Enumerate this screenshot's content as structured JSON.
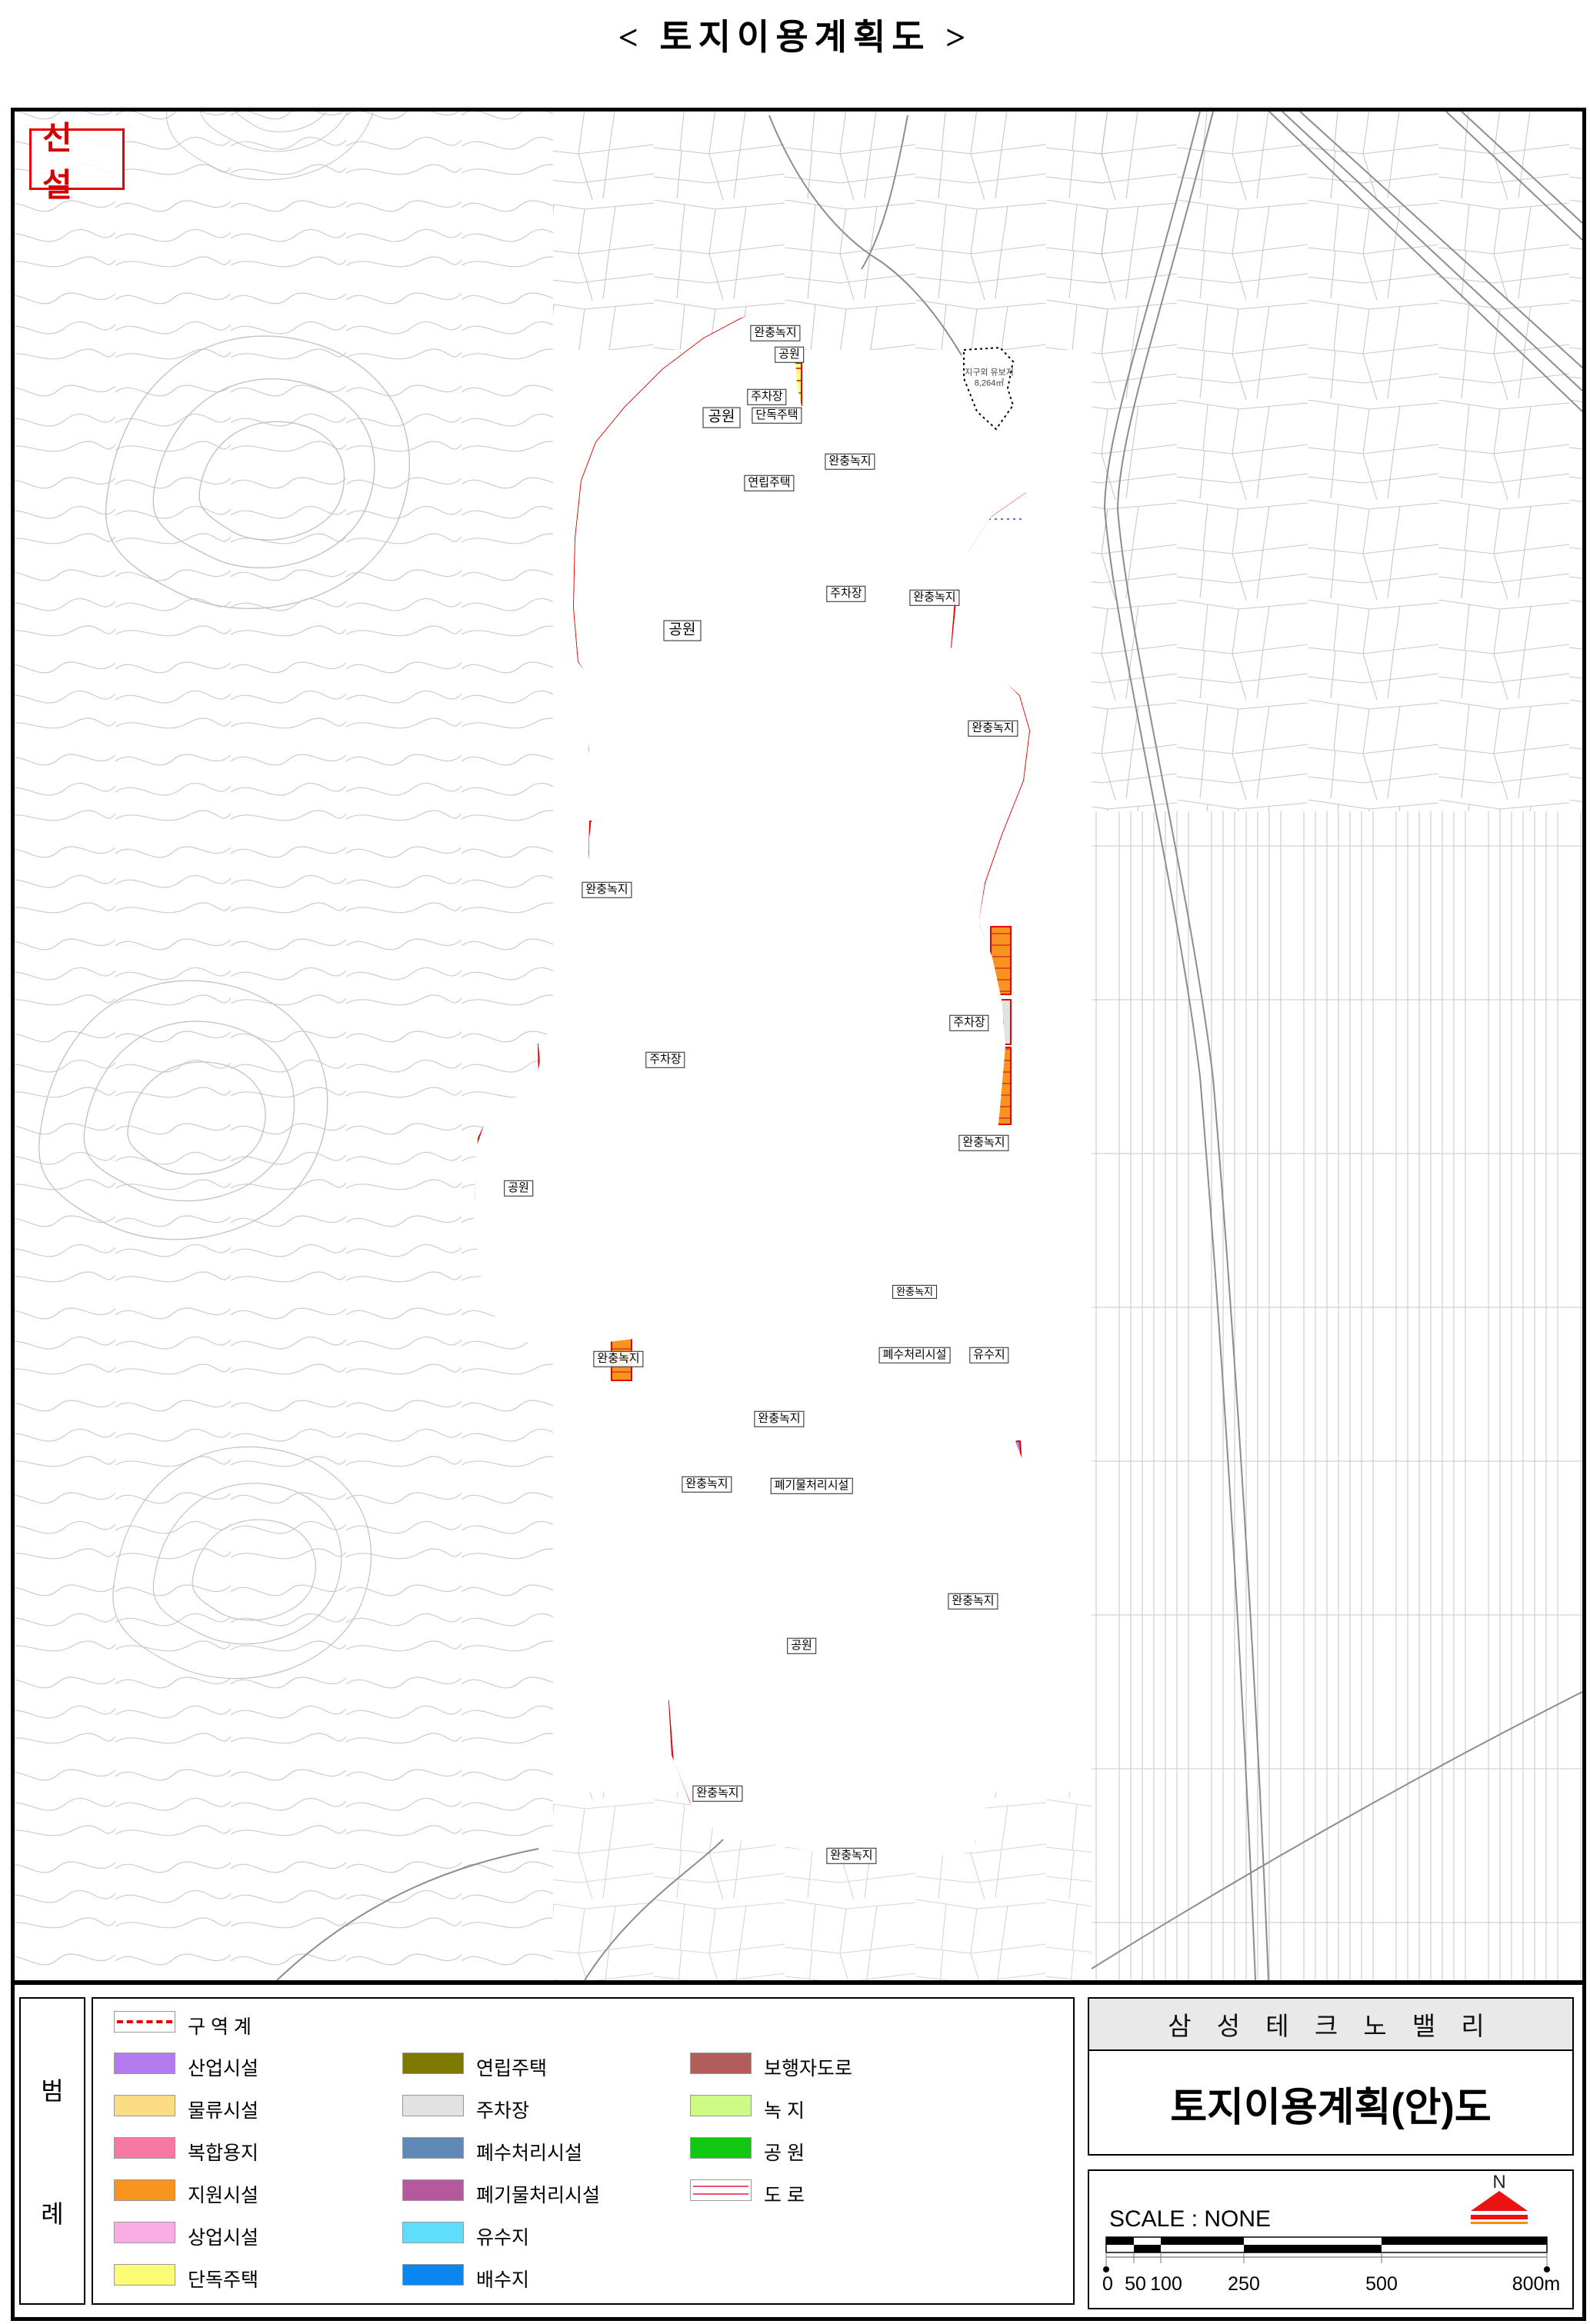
{
  "page": {
    "title": "< 토지이용계획도 >"
  },
  "map": {
    "corner_tag": "신 설",
    "annex": {
      "line1": "지구외 유보지",
      "line2": "8,264㎡"
    },
    "labels": [
      {
        "text": "완충녹지"
      },
      {
        "text": "공원"
      },
      {
        "text": "주차장"
      },
      {
        "text": "단독주택"
      },
      {
        "text": "연립주택"
      },
      {
        "text": "완충녹지"
      },
      {
        "text": "공원"
      },
      {
        "text": "주차장"
      },
      {
        "text": "완충녹지"
      },
      {
        "text": "공원"
      },
      {
        "text": "완충녹지"
      },
      {
        "text": "완충녹지"
      },
      {
        "text": "주차장"
      },
      {
        "text": "주차장"
      },
      {
        "text": "공원"
      },
      {
        "text": "완충녹지"
      },
      {
        "text": "완충녹지"
      },
      {
        "text": "완충녹지"
      },
      {
        "text": "폐수처리시설"
      },
      {
        "text": "유수지"
      },
      {
        "text": "완충녹지"
      },
      {
        "text": "폐기물처리시설"
      },
      {
        "text": "완충녹지"
      },
      {
        "text": "공원"
      },
      {
        "text": "완충녹지"
      },
      {
        "text": "완충녹지"
      },
      {
        "text": "완충녹지"
      }
    ]
  },
  "legend": {
    "panel_chars": [
      "범",
      "례"
    ],
    "items_col1": [
      {
        "label": "구 역 계",
        "type": "boundary-line"
      },
      {
        "label": "산업시설",
        "color": "#b27cef"
      },
      {
        "label": "물류시설",
        "color": "#fadc82"
      },
      {
        "label": "복합용지",
        "color": "#f878a4"
      },
      {
        "label": "지원시설",
        "color": "#f7941e"
      },
      {
        "label": "상업시설",
        "color": "#fbace5"
      },
      {
        "label": "단독주택",
        "color": "#fbfb75"
      }
    ],
    "items_col2": [
      {
        "label": "연립주택",
        "color": "#7e7a00"
      },
      {
        "label": "주차장",
        "color": "#e2e2e2"
      },
      {
        "label": "폐수처리시설",
        "color": "#5e88b5"
      },
      {
        "label": "폐기물처리시설",
        "color": "#b4599e"
      },
      {
        "label": "유수지",
        "color": "#5fdefb"
      },
      {
        "label": "배수지",
        "color": "#0a86f0"
      }
    ],
    "items_col3": [
      {
        "label": "보행자도로",
        "color": "#b35c5c"
      },
      {
        "label": "녹   지",
        "color": "#cdfb85"
      },
      {
        "label": "공   원",
        "color": "#0fc80f"
      },
      {
        "label": "도   로",
        "type": "road-swatch"
      }
    ]
  },
  "title_block": {
    "project": "삼 성 테 크 노 밸 리",
    "drawing": "토지이용계획(안)도"
  },
  "scale_block": {
    "scale_label": "SCALE : NONE",
    "north": "N",
    "ticks": [
      "0",
      "50",
      "100",
      "250",
      "500",
      "800m"
    ]
  },
  "colors": {
    "boundary": "#e60000",
    "park": "#0fc80f",
    "greenbelt": "#cdfb85",
    "industrial": "#b27cef",
    "logistics": "#fadc82",
    "mixed_use": "#f878a4",
    "support": "#f7941e",
    "commercial": "#fbace5",
    "detached_house": "#fbfb75",
    "row_house": "#7e7a00",
    "parking": "#e2e2e2",
    "wastewater": "#5e88b5",
    "waste": "#b4599e",
    "pond": "#5fdefb",
    "reservoir": "#0a86f0",
    "pedestrian": "#b35c5c"
  }
}
